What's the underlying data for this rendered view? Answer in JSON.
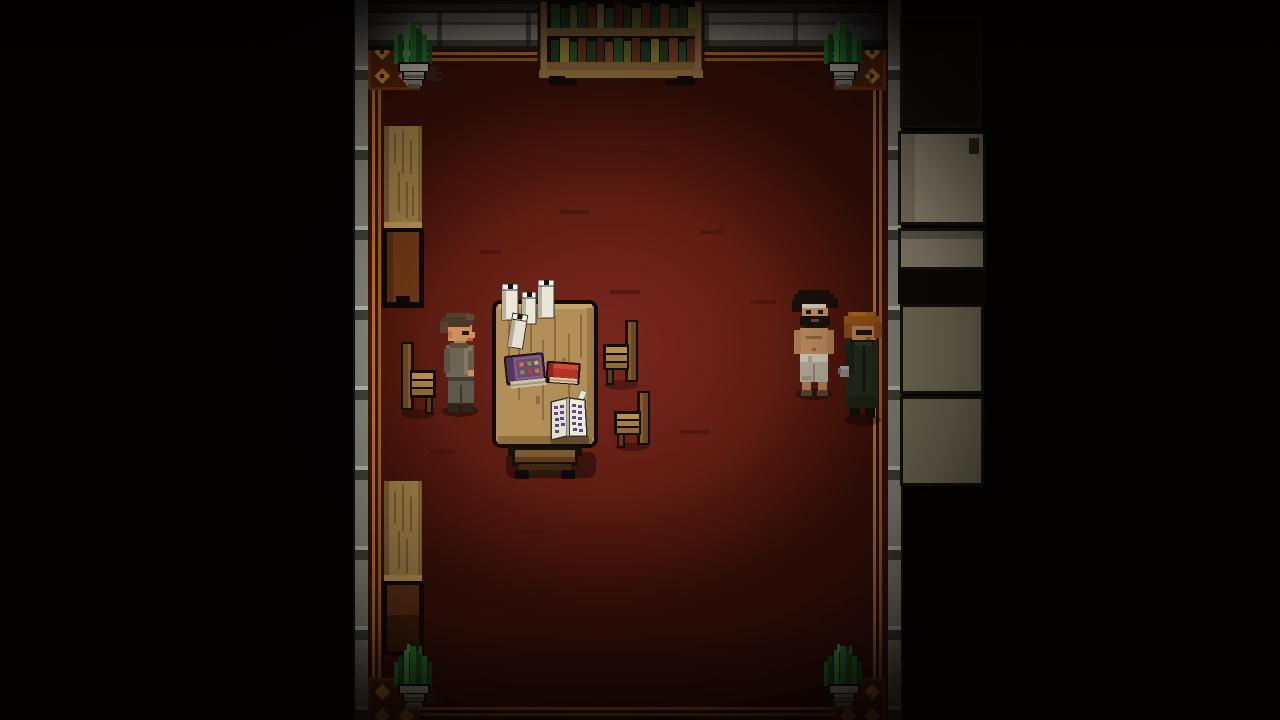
{
  "meta": {
    "app": "pixel-art-rpg",
    "scene_label": "Dark red-carpeted library room, top-down pixel RPG scene",
    "viewport": "1280x720",
    "hud_text": []
  },
  "palette": {
    "background": "#000000",
    "floor_red": "#6b2117",
    "floor_dark_edge": "#38100a",
    "border_gold_bright": "#c87c1e",
    "border_gold_dark": "#a5681a",
    "wall_gray": "#8d8d82",
    "wood_light": "#a5834a",
    "wood_dark": "#6e3916",
    "desk_wood": "#b28e58",
    "book_green": "#2c5a28",
    "candle_white": "#eae6d8",
    "panel_beige": "#aaa68d",
    "panel_olive": "#7e7c64",
    "plant_green": "#2f8c3c"
  },
  "scene": {
    "room": {
      "label": "Red-carpet room with ornate gold border and gray panelled walls"
    },
    "entities": {
      "player": {
        "label": "Player character - brown-haired man in gray-brown jacket facing right"
      },
      "npc_shirtless": {
        "label": "Shirtless bearded man with head bandage and light trousers"
      },
      "npc_coat": {
        "label": "Auburn-haired man in dark coat"
      },
      "desk": {
        "label": "Wooden writing desk on pedestal base"
      },
      "candles": {
        "label": "Cluster of white pillar candles"
      },
      "book_purple": {
        "label": "Closed purple jewelled tome"
      },
      "book_red": {
        "label": "Closed red book"
      },
      "book_open": {
        "label": "Open manuscript with quill"
      },
      "chair_left": {
        "label": "Wooden chair facing desk from the left"
      },
      "chair_right_upper": {
        "label": "Wooden chair right of desk (upper)"
      },
      "chair_right_lower": {
        "label": "Wooden chair right of desk (lower)"
      },
      "bookshelf": {
        "label": "Bookshelf filled with green and brown books"
      },
      "plant_top_left": {
        "label": "Potted aloe plant, top-left corner"
      },
      "plant_top_right": {
        "label": "Potted aloe plant, top-right corner"
      },
      "plant_bottom_left": {
        "label": "Potted aloe plant, bottom-left corner"
      },
      "plant_bottom_right": {
        "label": "Potted aloe plant, bottom-right corner"
      },
      "pillar_upper": {
        "label": "Tall wooden wall pillar, upper left wall"
      },
      "pillar_lower": {
        "label": "Tall wooden wall pillar, lower left wall"
      },
      "cabinet_panels": {
        "label": "Beige and olive wall panels in right hallway"
      }
    }
  }
}
